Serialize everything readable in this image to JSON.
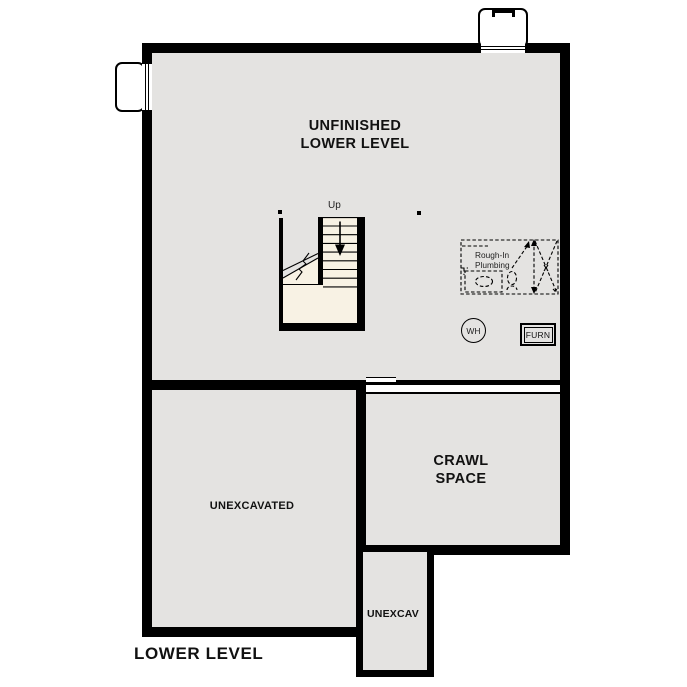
{
  "title": "LOWER LEVEL",
  "colors": {
    "floor": "#e4e3e1",
    "stairs": "#f8f2e4",
    "wall": "#000000",
    "ink": "#111111"
  },
  "rooms": {
    "main": {
      "label_line1": "UNFINISHED",
      "label_line2": "LOWER LEVEL"
    },
    "crawl": {
      "label_line1": "CRAWL",
      "label_line2": "SPACE"
    },
    "unexcavated": {
      "label": "UNEXCAVATED"
    },
    "unexcav": {
      "label": "UNEXCAV"
    }
  },
  "stairs": {
    "up_label": "Up"
  },
  "plumbing": {
    "label_line1": "Rough-In",
    "label_line2": "Plumbing"
  },
  "equipment": {
    "water_heater": "WH",
    "furnace": "FURN"
  }
}
